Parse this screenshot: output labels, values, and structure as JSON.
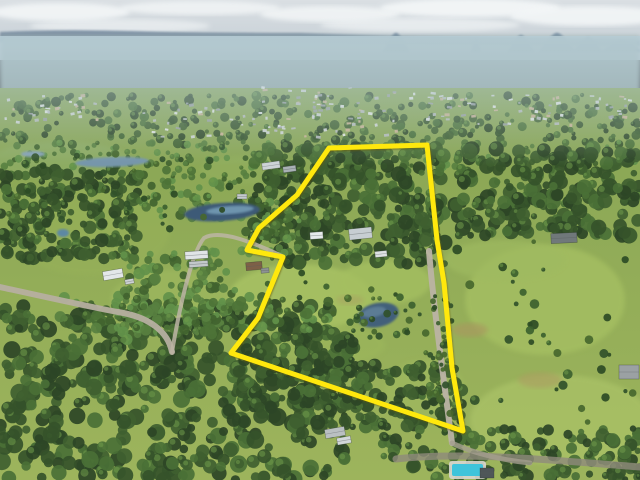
{
  "scene": {
    "description": "Aerial drone photograph of a semi-rural acreage property outlined with a yellow boundary line, distant conical mountains on the horizon, suburbs, forest, dams and paddocks",
    "boundary": {
      "color": "#ffe80a",
      "stroke_width": 5,
      "points": [
        [
          329,
          148
        ],
        [
          427,
          145
        ],
        [
          437,
          240
        ],
        [
          444,
          283
        ],
        [
          452,
          368
        ],
        [
          463,
          431
        ],
        [
          231,
          353
        ],
        [
          258,
          318
        ],
        [
          283,
          257
        ],
        [
          247,
          250
        ],
        [
          259,
          228
        ],
        [
          297,
          195
        ]
      ]
    },
    "sky": {
      "top": "#dadfe3",
      "bottom": "#c2ccd3",
      "cloud": "#f3f6f7",
      "ridge": "#7b8fa3",
      "mountain": "#68809a"
    },
    "land": {
      "top": "#87a455",
      "bottom": "#9db45c",
      "haze": "#b7cdd6"
    },
    "mountains": [
      {
        "x": 396,
        "w": 26,
        "h": 19
      },
      {
        "x": 476,
        "w": 9,
        "h": 14
      },
      {
        "x": 521,
        "w": 26,
        "h": 17
      },
      {
        "x": 557,
        "w": 36,
        "h": 19
      },
      {
        "x": 588,
        "w": 28,
        "h": 15
      },
      {
        "x": 622,
        "w": 40,
        "h": 12
      }
    ],
    "clouds": [
      {
        "cx": 60,
        "cy": 12,
        "rx": 70,
        "ry": 9,
        "o": 0.9
      },
      {
        "cx": 200,
        "cy": 8,
        "rx": 80,
        "ry": 7,
        "o": 0.8
      },
      {
        "cx": 330,
        "cy": 14,
        "rx": 70,
        "ry": 8,
        "o": 0.85
      },
      {
        "cx": 470,
        "cy": 8,
        "rx": 90,
        "ry": 9,
        "o": 0.95
      },
      {
        "cx": 590,
        "cy": 16,
        "rx": 80,
        "ry": 10,
        "o": 0.9
      },
      {
        "cx": 120,
        "cy": 26,
        "rx": 90,
        "ry": 7,
        "o": 0.6
      },
      {
        "cx": 420,
        "cy": 25,
        "rx": 100,
        "ry": 7,
        "o": 0.65
      }
    ],
    "fields": [
      {
        "cx": 300,
        "cy": 298,
        "rx": 72,
        "ry": 34,
        "c": "#a8c263",
        "o": 0.85
      },
      {
        "cx": 385,
        "cy": 282,
        "rx": 46,
        "ry": 22,
        "c": "#a4bf60",
        "o": 0.8
      },
      {
        "cx": 330,
        "cy": 345,
        "rx": 55,
        "ry": 20,
        "c": "#9cb75c",
        "o": 0.6
      },
      {
        "cx": 545,
        "cy": 300,
        "rx": 80,
        "ry": 55,
        "c": "#a5bf62",
        "o": 0.8
      },
      {
        "cx": 560,
        "cy": 420,
        "rx": 90,
        "ry": 45,
        "c": "#a9c166",
        "o": 0.8
      },
      {
        "cx": 90,
        "cy": 230,
        "rx": 80,
        "ry": 45,
        "c": "#96b058",
        "o": 0.7
      },
      {
        "cx": 170,
        "cy": 300,
        "rx": 60,
        "ry": 30,
        "c": "#9db85e",
        "o": 0.7
      },
      {
        "cx": 60,
        "cy": 160,
        "rx": 70,
        "ry": 18,
        "c": "#8fae6b",
        "o": 0.6
      },
      {
        "cx": 505,
        "cy": 260,
        "rx": 60,
        "ry": 20,
        "c": "#9fba60",
        "o": 0.7
      },
      {
        "cx": 425,
        "cy": 390,
        "rx": 40,
        "ry": 30,
        "c": "#a0ba5e",
        "o": 0.6
      },
      {
        "cx": 250,
        "cy": 170,
        "rx": 50,
        "ry": 14,
        "c": "#93b05e",
        "o": 0.6
      },
      {
        "cx": 470,
        "cy": 330,
        "rx": 18,
        "ry": 7,
        "c": "#a79a5f",
        "o": 0.7
      },
      {
        "cx": 540,
        "cy": 380,
        "rx": 22,
        "ry": 8,
        "c": "#ab9d60",
        "o": 0.6
      },
      {
        "cx": 350,
        "cy": 300,
        "rx": 14,
        "ry": 5,
        "c": "#a89f62",
        "o": 0.5
      }
    ],
    "ponds": [
      {
        "type": "ellipse",
        "cx": 112,
        "cy": 162,
        "rx": 37,
        "ry": 5,
        "rot": -2,
        "c": "#7495aa"
      },
      {
        "type": "ellipse",
        "cx": 33,
        "cy": 154,
        "rx": 12,
        "ry": 3,
        "rot": 0,
        "c": "#86a3b4"
      },
      {
        "type": "ellipse",
        "cx": 222,
        "cy": 212,
        "rx": 38,
        "ry": 9,
        "rot": -4,
        "c": "#3c5a77"
      },
      {
        "type": "ellipse",
        "cx": 230,
        "cy": 210,
        "rx": 24,
        "ry": 4,
        "rot": -4,
        "c": "#6e94ad"
      },
      {
        "type": "ellipse",
        "cx": 63,
        "cy": 233,
        "rx": 6,
        "ry": 4,
        "rot": 0,
        "c": "#5d88a3"
      },
      {
        "type": "ellipse",
        "cx": 378,
        "cy": 315,
        "rx": 21,
        "ry": 12,
        "rot": -12,
        "c": "#43607a"
      },
      {
        "type": "ellipse",
        "cx": 374,
        "cy": 312,
        "rx": 12,
        "ry": 5,
        "rot": -12,
        "c": "#5b7b94"
      },
      {
        "type": "rect",
        "x": 452,
        "y": 464,
        "w": 31,
        "h": 12,
        "c": "#3fc4da"
      }
    ],
    "roads": [
      {
        "d": "M0,287 C50,298 95,308 118,312 C150,317 168,332 172,352",
        "w": 6,
        "c": "#b6afa0",
        "o": 0.95
      },
      {
        "d": "M172,352 C180,305 192,252 204,238 C220,229 252,242 282,256",
        "w": 4,
        "c": "#bdb5a4",
        "o": 0.85
      },
      {
        "d": "M429,251 C433,300 441,360 452,443",
        "w": 6,
        "c": "#bab3a4",
        "o": 0.95
      },
      {
        "d": "M396,459 C470,451 560,461 640,467",
        "w": 7,
        "c": "#8f897c",
        "o": 0.8
      },
      {
        "d": "M452,443 C470,452 500,460 530,463",
        "w": 5,
        "c": "#a49d8e",
        "o": 0.8
      }
    ],
    "buildings": [
      {
        "x": 262,
        "y": 162,
        "w": 18,
        "h": 7,
        "c": "#cdd3d6",
        "r": -8
      },
      {
        "x": 283,
        "y": 166,
        "w": 13,
        "h": 6,
        "c": "#a9b1b5",
        "r": -8
      },
      {
        "x": 237,
        "y": 194,
        "w": 10,
        "h": 5,
        "c": "#c4cacd",
        "r": 0
      },
      {
        "x": 185,
        "y": 251,
        "w": 23,
        "h": 8,
        "c": "#e0e4e6",
        "r": -4
      },
      {
        "x": 189,
        "y": 261,
        "w": 19,
        "h": 6,
        "c": "#c3c8ca",
        "r": -4
      },
      {
        "x": 246,
        "y": 262,
        "w": 16,
        "h": 8,
        "c": "#7d6047",
        "r": -5
      },
      {
        "x": 261,
        "y": 268,
        "w": 8,
        "h": 5,
        "c": "#8d9292",
        "r": -5
      },
      {
        "x": 103,
        "y": 270,
        "w": 20,
        "h": 9,
        "c": "#e3e7e9",
        "r": -10
      },
      {
        "x": 125,
        "y": 279,
        "w": 9,
        "h": 5,
        "c": "#ced2d4",
        "r": -10
      },
      {
        "x": 310,
        "y": 232,
        "w": 13,
        "h": 7,
        "c": "#e6eaec",
        "r": -4
      },
      {
        "x": 349,
        "y": 228,
        "w": 23,
        "h": 11,
        "c": "#c7ced2",
        "r": -6
      },
      {
        "x": 375,
        "y": 251,
        "w": 12,
        "h": 6,
        "c": "#dde1e3",
        "r": -6
      },
      {
        "x": 551,
        "y": 233,
        "w": 26,
        "h": 10,
        "c": "#70787a",
        "r": -3
      },
      {
        "x": 619,
        "y": 365,
        "w": 20,
        "h": 14,
        "c": "#9ba1a3",
        "r": 0
      },
      {
        "x": 325,
        "y": 428,
        "w": 20,
        "h": 9,
        "c": "#bac0c2",
        "r": -10
      },
      {
        "x": 337,
        "y": 437,
        "w": 14,
        "h": 7,
        "c": "#d3d8da",
        "r": -10
      },
      {
        "x": 480,
        "y": 468,
        "w": 14,
        "h": 10,
        "c": "#4e5658",
        "r": 0
      }
    ]
  }
}
